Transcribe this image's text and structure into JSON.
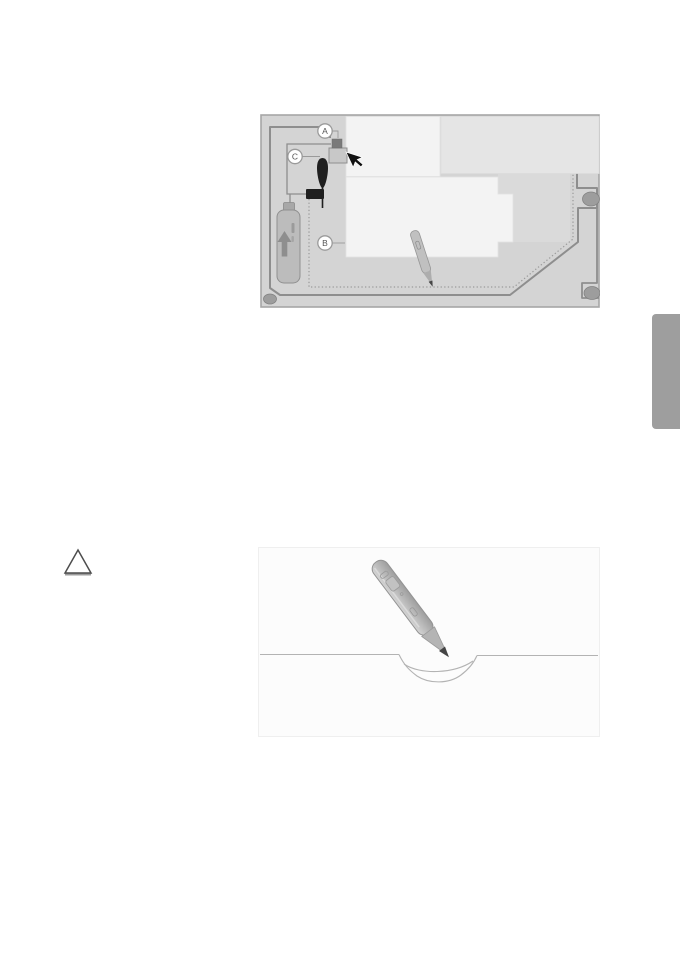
{
  "theme": {
    "page-bg": "#ffffff",
    "tab-gray": "#9e9e9e",
    "yard": "#d4d4d4",
    "frame": "#a6a6a6",
    "wire": "#8e8e8e",
    "dotted": "#9a9a9a",
    "building-light": "#f3f3f3",
    "building-shade": "#e5e5e5",
    "building-mid": "#dadada",
    "obstacle": "#9d9d9d",
    "label-stroke": "#9a9a9a",
    "label-text": "#555555",
    "tool-dark": "#1f1f1f",
    "station-dark": "#7a7a7a",
    "station-base": "#c8c8c8",
    "line-light": "#b3b3b3",
    "fig2-bg": "#fcfcfc",
    "pen-tip": "#454545",
    "triangle": "#4d4d4d"
  },
  "page": {
    "side_tab": {
      "icon": "section-edge-tab"
    },
    "warning": {
      "icon": "warning-triangle-icon"
    }
  },
  "figure_installation_map": {
    "name": "boundary-wire-installation-overview",
    "callouts": [
      {
        "label": "A"
      },
      {
        "label": "B"
      },
      {
        "label": "C"
      }
    ],
    "icons": [
      "charging-station",
      "mouse-cursor-icon",
      "awl-tool-icon",
      "wire-connector",
      "spray-can-icon",
      "gauge-pen-icon",
      "obstacle-oval",
      "boundary-wire-solid",
      "boundary-wire-dotted"
    ]
  },
  "figure_wire_trench": {
    "name": "wire-trench-cross-section",
    "icons": [
      "gauge-pen-icon",
      "ground-line",
      "wire-trench"
    ]
  }
}
